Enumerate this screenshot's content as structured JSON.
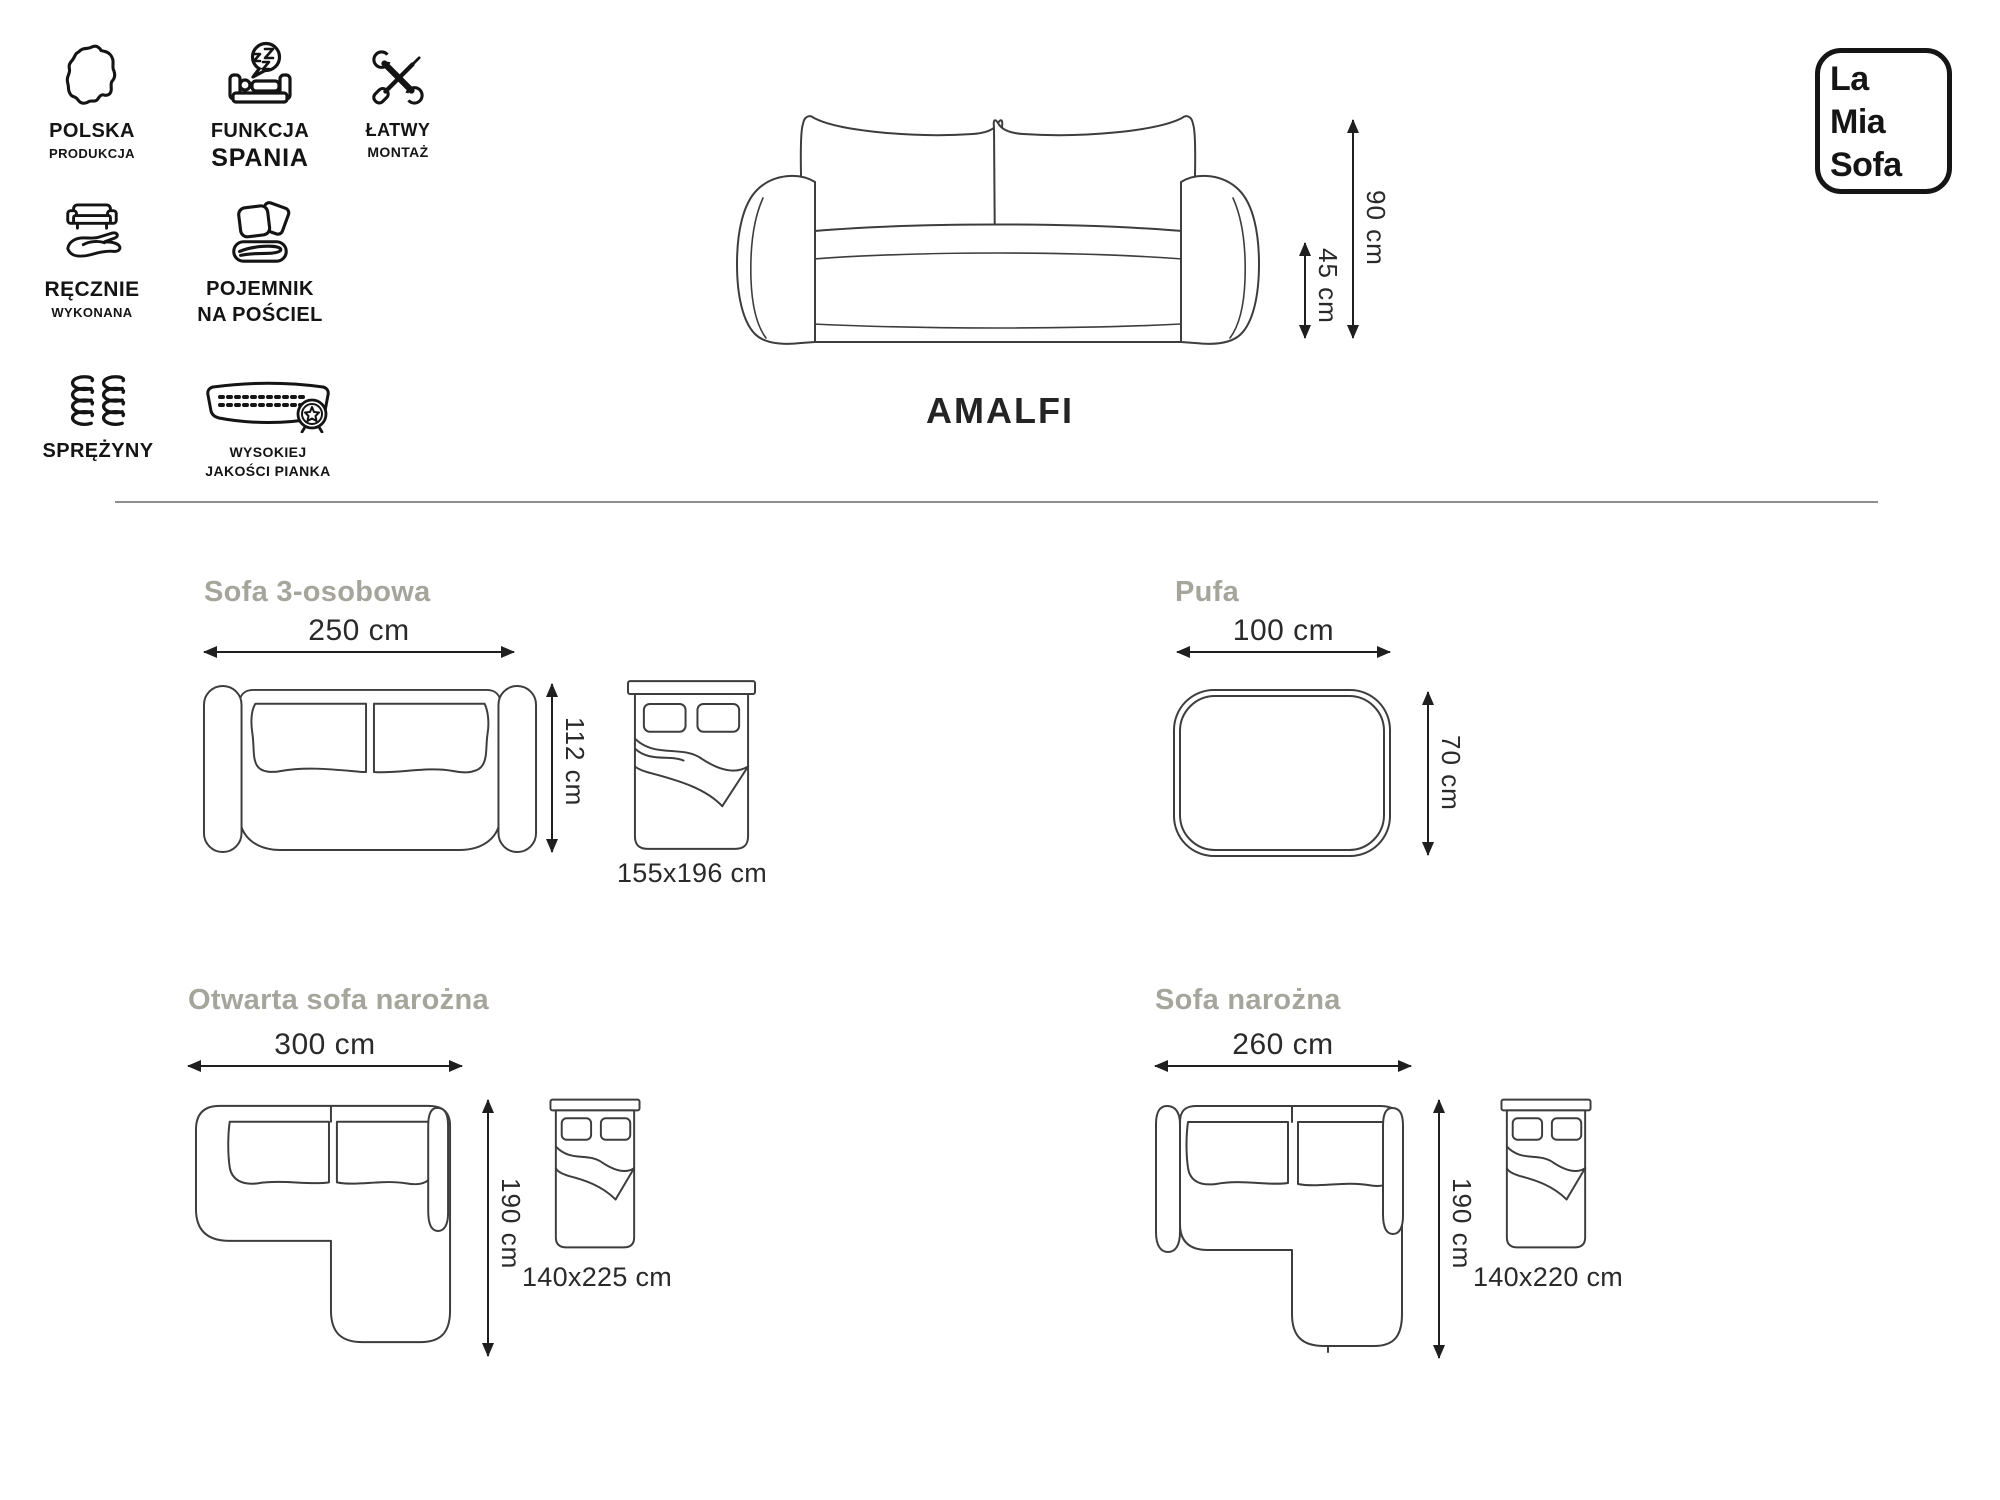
{
  "brand": {
    "line1": "La",
    "line2": "Mia",
    "line3": "Sofa"
  },
  "product": {
    "name": "AMALFI",
    "total_height": "90 cm",
    "seat_height": "45 cm"
  },
  "features": [
    {
      "label1": "POLSKA",
      "label2": "PRODUKCJA",
      "icon": "poland-map-icon"
    },
    {
      "label1": "FUNKCJA",
      "label2": "SPANIA",
      "icon": "sleep-function-icon"
    },
    {
      "label1": "ŁATWY",
      "label2": "MONTAŻ",
      "icon": "easy-assembly-tools-icon"
    },
    {
      "label1": "RĘCZNIE",
      "label2": "WYKONANA",
      "icon": "handmade-sofa-hand-icon"
    },
    {
      "label1": "POJEMNIK",
      "label2": "NA POŚCIEL",
      "icon": "bedding-storage-icon"
    },
    {
      "label1": "SPRĘŻYNY",
      "label2": "",
      "icon": "springs-icon"
    },
    {
      "label1": "WYSOKIEJ",
      "label2": "JAKOŚCI PIANKA",
      "icon": "high-quality-foam-icon"
    }
  ],
  "variants": [
    {
      "title": "Sofa 3-osobowa",
      "width": "250 cm",
      "depth": "112 cm",
      "bed_size": "155x196 cm"
    },
    {
      "title": "Pufa",
      "width": "100 cm",
      "depth": "70 cm"
    },
    {
      "title": "Otwarta sofa narożna",
      "width": "300 cm",
      "depth": "190 cm",
      "bed_size": "140x225 cm"
    },
    {
      "title": "Sofa narożna",
      "width": "260 cm",
      "depth": "190 cm",
      "bed_size": "140x220 cm"
    }
  ],
  "colors": {
    "ink": "#1f1f1f",
    "icon": "#141414",
    "line_art": "#3d3d3d",
    "muted_title": "#a5a59c",
    "divider": "#8e8e8e"
  }
}
